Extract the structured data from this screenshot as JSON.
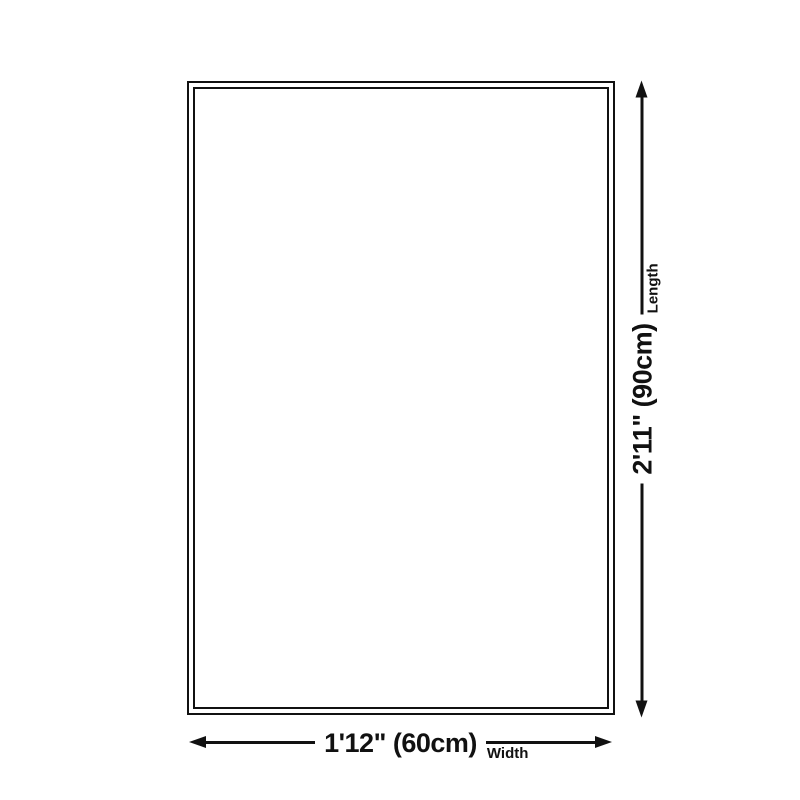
{
  "diagram": {
    "colors": {
      "line": "#111111",
      "background": "#ffffff"
    },
    "length_dimension": {
      "value": "2'11\" (90cm)",
      "label": "Length"
    },
    "width_dimension": {
      "value": "1'12\" (60cm)",
      "label": "Width"
    }
  }
}
